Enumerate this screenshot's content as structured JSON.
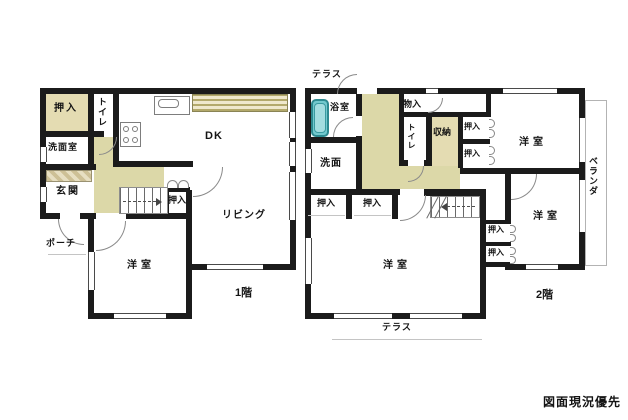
{
  "floor1": {
    "label": "1階",
    "rooms": {
      "closet_nw": "押入",
      "toilet": "トイレ",
      "washroom": "洗面室",
      "entrance": "玄関",
      "porch": "ポーチ",
      "dining_kitchen": "DK",
      "closet_mid": "押入",
      "living": "リビング",
      "bedroom": "洋室"
    }
  },
  "floor2": {
    "label": "2階",
    "rooms": {
      "terrace_top": "テラス",
      "bathroom": "浴室",
      "washroom": "洗面",
      "storage_small": "物入",
      "toilet": "トイレ",
      "storage": "収納",
      "closet_e1": "押入",
      "closet_e2": "押入",
      "bedroom_ne": "洋室",
      "veranda": "ベランダ",
      "bedroom_e": "洋室",
      "closet_se1": "押入",
      "closet_se2": "押入",
      "closet_w1": "押入",
      "closet_w2": "押入",
      "bedroom_main": "洋室",
      "terrace_bottom": "テラス"
    }
  },
  "note": {
    "priority": "図面現況優先"
  },
  "colors": {
    "wall": "#1b1b1b",
    "hallway_tint": "#dcd8a8",
    "closet_tint": "#e4dcb2",
    "bathtub": "#72c9ce",
    "stripe_band": "#b3a96b"
  }
}
